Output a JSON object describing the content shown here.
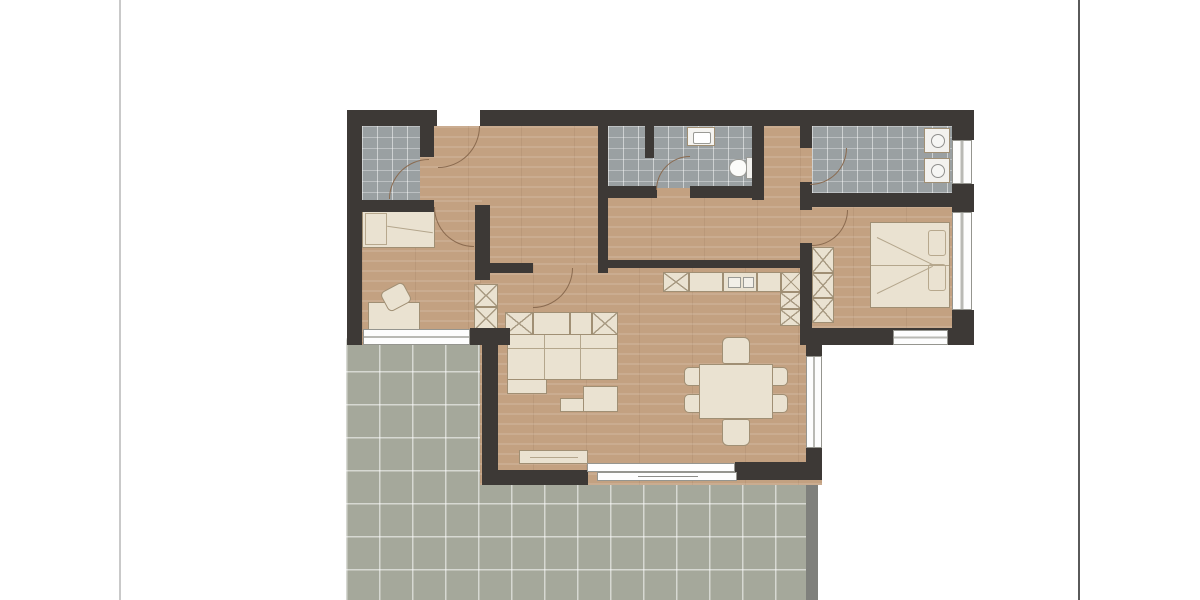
{
  "palette": {
    "page_bg": "#ffffff",
    "wall": "#3d3936",
    "wood_floor": "#c3a181",
    "gray_tile_floor": "#9aa0a2",
    "terrace_floor": "#a5a89b",
    "terrace_edge": "#7f807c",
    "furniture_fill": "#eae2d1",
    "furniture_outline": "#a08f74",
    "window_fill": "#fdfdfd",
    "window_frame": "#95958f",
    "door_arc": "#8a6a4f",
    "left_page_rule": "#c9c9c9",
    "right_page_rule": "#5a5a5a"
  },
  "floor_plan": {
    "kind": "apartment-floor-plan-top-view",
    "rooms": [
      {
        "id": "entry-hall",
        "floor": "wood",
        "features": [
          "entrance-door"
        ]
      },
      {
        "id": "storage-room",
        "floor": "gray-tile",
        "features": [
          "door"
        ]
      },
      {
        "id": "bathroom",
        "floor": "gray-tile",
        "features": [
          "sink",
          "toilet",
          "shower-partition",
          "door"
        ]
      },
      {
        "id": "utility-room",
        "floor": "gray-tile",
        "features": [
          "washing-machine",
          "dryer",
          "window",
          "door"
        ]
      },
      {
        "id": "bedroom",
        "floor": "wood",
        "features": [
          "double-bed",
          "wardrobe",
          "two-windows",
          "door"
        ]
      },
      {
        "id": "office-room",
        "floor": "wood",
        "features": [
          "single-bed",
          "desk",
          "chair",
          "cabinet",
          "window"
        ]
      },
      {
        "id": "living-dining-kitchen",
        "floor": "wood",
        "features": [
          "sofa",
          "sideboard",
          "coffee-table",
          "tv-board",
          "dining-table",
          "six-chairs",
          "kitchen-counter",
          "tall-kitchen-unit",
          "sliding-terrace-door",
          "window"
        ]
      },
      {
        "id": "terrace",
        "floor": "outdoor-tile-grid"
      }
    ]
  }
}
